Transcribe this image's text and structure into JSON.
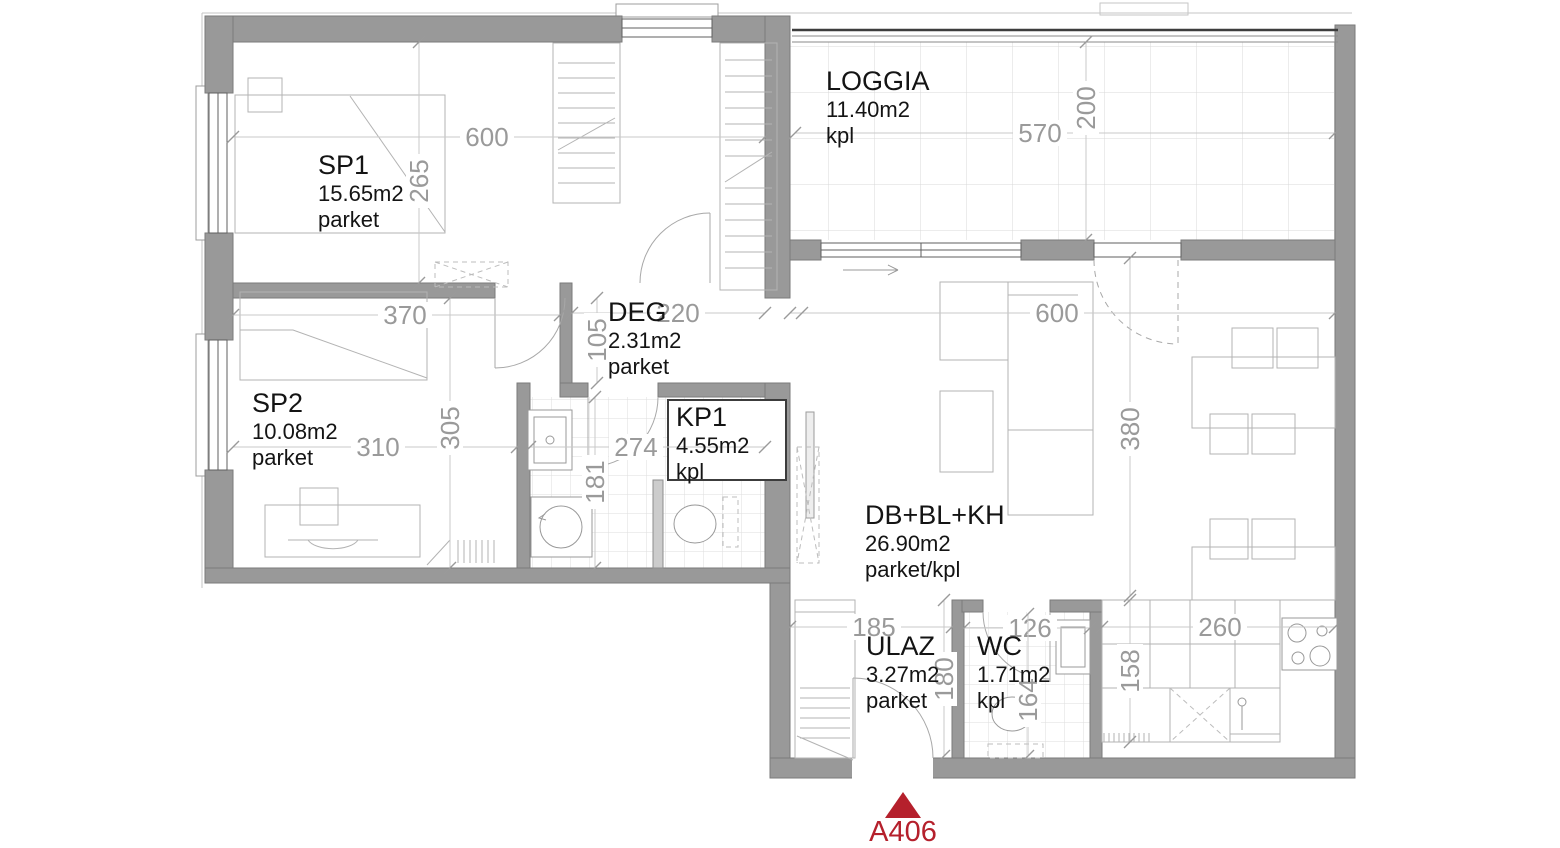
{
  "title": "Apartment floor plan",
  "marker": {
    "label": "A406",
    "color": "#b5202c"
  },
  "rooms": {
    "sp1": {
      "name": "SP1",
      "area": "15.65m2",
      "floor": "parket"
    },
    "loggia": {
      "name": "LOGGIA",
      "area": "11.40m2",
      "floor": "kpl"
    },
    "deg": {
      "name": "DEG",
      "area": "2.31m2",
      "floor": "parket"
    },
    "sp2": {
      "name": "SP2",
      "area": "10.08m2",
      "floor": "parket"
    },
    "kp1": {
      "name": "KP1",
      "area": "4.55m2",
      "floor": "kpl"
    },
    "living": {
      "name": "DB+BL+KH",
      "area": "26.90m2",
      "floor": "parket/kpl"
    },
    "ulaz": {
      "name": "ULAZ",
      "area": "3.27m2",
      "floor": "parket"
    },
    "wc": {
      "name": "WC",
      "area": "1.71m2",
      "floor": "kpl"
    }
  },
  "dims": {
    "sp1_width": "600",
    "sp1_depth": "265",
    "loggia_width": "570",
    "loggia_depth": "200",
    "sp2_top_width": "370",
    "deg_width": "220",
    "deg_depth": "105",
    "sp2_width": "310",
    "sp2_depth": "305",
    "kp1_width": "274",
    "kp1_depth": "181",
    "living_width": "600",
    "living_depth": "380",
    "ulaz_width": "185",
    "ulaz_depth": "180",
    "wc_width": "126",
    "wc_depth": "164",
    "kitchen_width": "260",
    "kitchen_depth": "158"
  },
  "colors": {
    "wall": "#999999",
    "dimension_text": "#9a9a9a",
    "label_text": "#141414",
    "marker_red": "#b5202c"
  }
}
